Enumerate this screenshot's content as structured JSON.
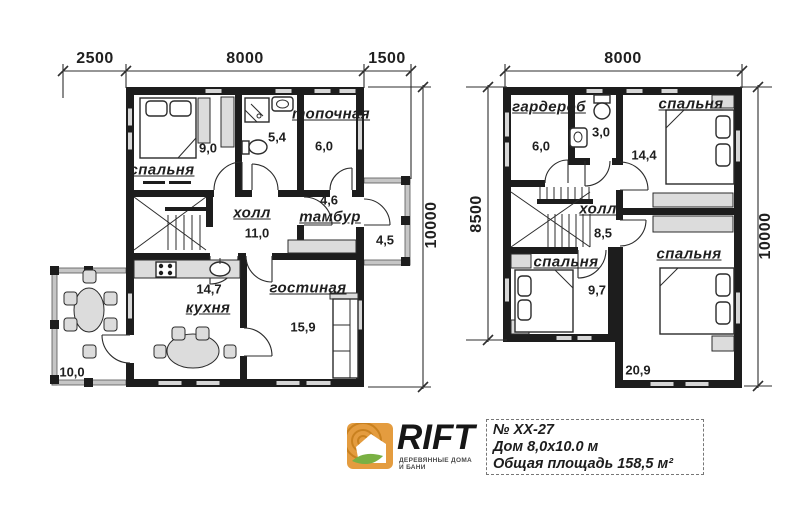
{
  "floor1": {
    "dim_top_left": "2500",
    "dim_top_mid": "8000",
    "dim_top_right": "1500",
    "dim_right": "10000",
    "rooms": {
      "bedroom": {
        "name": "спальня",
        "area": "9,0"
      },
      "bathroom": {
        "area": "5,4"
      },
      "boiler": {
        "name": "топочная",
        "area": "6,0"
      },
      "hall": {
        "name": "холл",
        "area": "11,0"
      },
      "vestibule": {
        "name": "тамбур",
        "area": "4,6"
      },
      "porch": {
        "area": "4,5"
      },
      "kitchen": {
        "name": "кухня",
        "area": "14,7"
      },
      "living": {
        "name": "гостиная",
        "area": "15,9"
      },
      "terrace": {
        "area": "10,0"
      }
    }
  },
  "floor2": {
    "dim_top": "8000",
    "dim_left": "8500",
    "dim_right": "10000",
    "rooms": {
      "wardrobe": {
        "name": "гардероб",
        "area": "6,0"
      },
      "bathroom": {
        "area": "3,0"
      },
      "bedroom1": {
        "name": "спальня",
        "area": "14,4"
      },
      "hall": {
        "name": "холл",
        "area": "8,5"
      },
      "bedroom2": {
        "name": "спальня",
        "area": "9,7"
      },
      "bedroom3": {
        "name": "спальня",
        "area": "20,9"
      }
    }
  },
  "footer": {
    "brand": "RIFT",
    "tagline": "ДЕРЕВЯННЫЕ ДОМА И БАНИ",
    "project_number": "№ ХХ-27",
    "house_size": "Дом 8,0х10.0 м",
    "total_area": "Общая площадь 158,5 м²"
  },
  "colors": {
    "wall": "#1d1d1d",
    "furniture_gray": "#dcdcdc",
    "logo_orange": "#e49c3f",
    "logo_green": "#79b043"
  }
}
